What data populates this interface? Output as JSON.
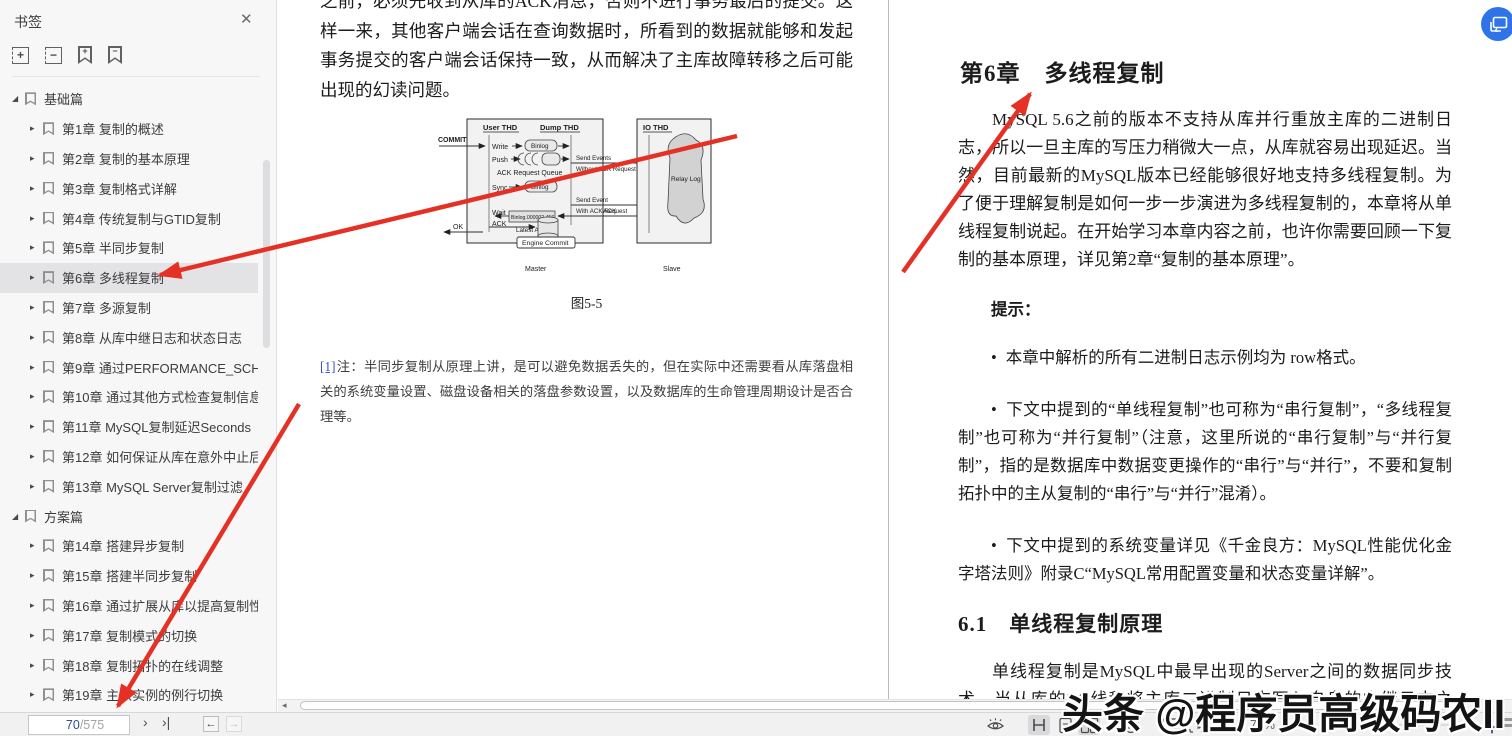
{
  "app": {
    "watermark": "头条 @程序员高级码农II"
  },
  "sidebar": {
    "title": "书签",
    "close_icon": "✕",
    "caret_expanded": "◢",
    "caret_collapsed": "▸",
    "tools": {
      "expand_plus": "+",
      "expand_minus": "−",
      "bm_plus": "+",
      "bm_minus": "−"
    },
    "items": [
      {
        "label": "基础篇"
      },
      {
        "label": "第1章 复制的概述"
      },
      {
        "label": "第2章 复制的基本原理"
      },
      {
        "label": "第3章 复制格式详解"
      },
      {
        "label": "第4章 传统复制与GTID复制"
      },
      {
        "label": "第5章 半同步复制"
      },
      {
        "label": "第6章 多线程复制"
      },
      {
        "label": "第7章 多源复制"
      },
      {
        "label": "第8章 从库中继日志和状态日志"
      },
      {
        "label": "第9章 通过PERFORMANCE_SCHI"
      },
      {
        "label": "第10章 通过其他方式检查复制信息"
      },
      {
        "label": "第11章 MySQL复制延迟Seconds"
      },
      {
        "label": "第12章 如何保证从库在意外中止后"
      },
      {
        "label": "第13章 MySQL Server复制过滤"
      },
      {
        "label": "方案篇"
      },
      {
        "label": "第14章 搭建异步复制"
      },
      {
        "label": "第15章 搭建半同步复制"
      },
      {
        "label": "第16章 通过扩展从库以提高复制性"
      },
      {
        "label": "第17章 复制模式的切换"
      },
      {
        "label": "第18章 复制拓扑的在线调整"
      },
      {
        "label": "第19章 主从实例的例行切换"
      }
    ]
  },
  "left_page": {
    "para_top": "之前，必须先收到从库的ACK消息，否则不进行事务最后的提交。这样一来，其他客户端会话在查询数据时，所看到的数据就能够和发起事务提交的客户端会话保持一致，从而解决了主库故障转移之后可能出现的幻读问题。",
    "figure_caption": "图5-5",
    "footnote_ref": "[1]",
    "footnote_text": "注：半同步复制从原理上讲，是可以避免数据丢失的，但在实际中还需要看从库落盘相关的系统变量设置、磁盘设备相关的落盘参数设置，以及数据库的生命管理周期设计是否合理等。",
    "figure": {
      "commit": "COMMIT",
      "user_thd": "User THD",
      "dump_thd": "Dump THD",
      "io_thd": "IO THD",
      "write": "Write",
      "push": "Push",
      "sync": "Sync",
      "wait": "Wait",
      "ack_left": "ACK",
      "ok": "OK",
      "binlog_top": "Binlog",
      "binlog_mid": "Binlog",
      "ack_queue": "ACK Request Queue",
      "send1a": "Send Events",
      "send1b": "Without ACK Request",
      "send2a": "Send Event",
      "send2b": "With ACK Request",
      "latest_ack_value": "Binlog.000002,456",
      "latest_ack": "Latest ACK",
      "ack_mid": "ACK",
      "engine_commit": "Engine Commit",
      "relay_log": "Relay Log",
      "master": "Master",
      "slave": "Slave"
    }
  },
  "right_page": {
    "chapter_title": "第6章　多线程复制",
    "para1": "MySQL 5.6之前的版本不支持从库并行重放主库的二进制日志，所以一旦主库的写压力稍微大一点，从库就容易出现延迟。当然，目前最新的MySQL版本已经能够很好地支持多线程复制。为了便于理解复制是如何一步一步演进为多线程复制的，本章将从单线程复制说起。在开始学习本章内容之前，也许你需要回顾一下复制的基本原理，详见第2章“复制的基本原理”。",
    "tip_label": "提示：",
    "bullet_char": "•",
    "bullets": [
      {
        "text": "本章中解析的所有二进制日志示例均为 row格式。"
      },
      {
        "text": "下文中提到的“单线程复制”也可称为“串行复制”，“多线程复制”也可称为“并行复制”（注意，这里所说的“串行复制”与“并行复制”，指的是数据库中数据变更操作的“串行”与“并行”，不要和复制拓扑中的主从复制的“串行”与“并行”混淆）。"
      },
      {
        "text": "下文中提到的系统变量详见《千金良方：MySQL性能优化金字塔法则》附录C“MySQL常用配置变量和状态变量详解”。"
      }
    ],
    "section_title": "6.1　单线程复制原理",
    "para2": "单线程复制是MySQL中最早出现的Server之间的数据同步技术，当从库的I/O线程将主库二进制日志写入自身的中继日志之后，读取中继日志并进行回放的线程只有一个，也就是SQL Thread（SQL线程），参见图6-1。"
  },
  "bottombar": {
    "page_current": "70",
    "page_total": "/575",
    "next_icon": "›",
    "last_icon": "›|",
    "back_icon": "←",
    "forward_icon": "→",
    "scroll_left_icon": "◂",
    "zoom_level": "75%",
    "zoom_caret": "⌄",
    "zoom_out": "−",
    "zoom_in": "＋"
  },
  "colors": {
    "accent_red": "#e53125",
    "link_blue": "#3c55c0",
    "badge_blue": "#2e74e8",
    "highlight": "#e3e3e5"
  }
}
